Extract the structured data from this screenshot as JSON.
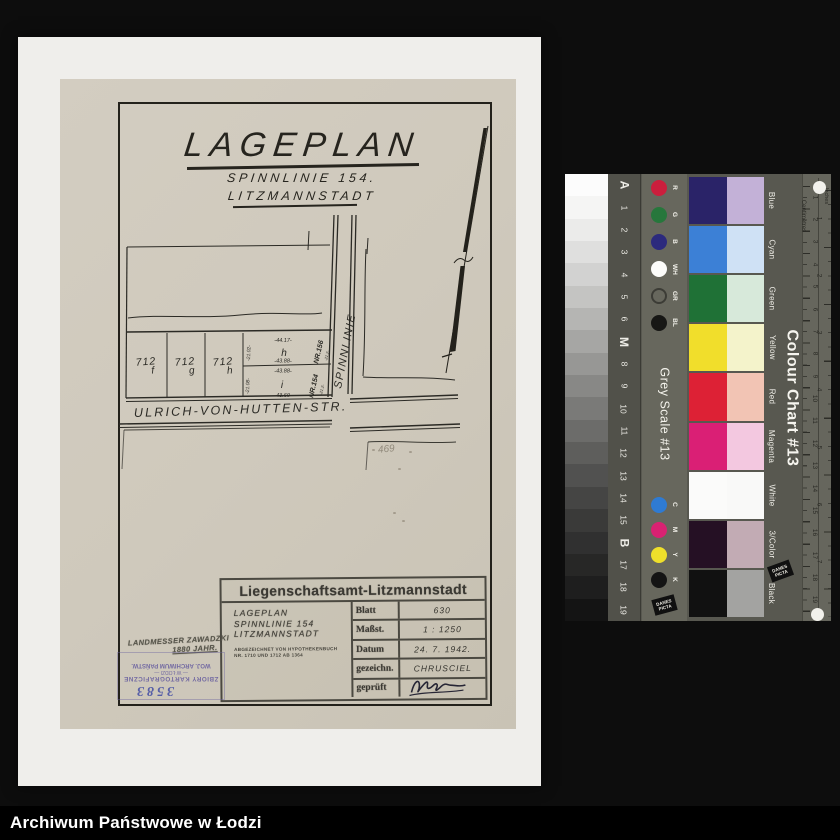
{
  "footer": {
    "archive_name": "Archiwum Państwowe w Łodzi"
  },
  "document": {
    "title": "LAGEPLAN",
    "subtitle1": "SPINNLINIE 154.",
    "subtitle2": "LITZMANNSTADT",
    "map": {
      "street_vertical": "SPINNLINIE",
      "street_horizontal": "ULRICH-VON-HUTTEN-STR.",
      "plots": [
        {
          "number": "712",
          "letter": "f"
        },
        {
          "number": "712",
          "letter": "g"
        },
        {
          "number": "712",
          "letter": "h"
        }
      ],
      "parcels": [
        {
          "label": "h",
          "nr": "NR.156",
          "top": "-44.17-",
          "bottom": "-43.88-",
          "left": "-21.02-",
          "side": "-21.2-"
        },
        {
          "label": "i",
          "nr": "NR.154",
          "top": "-43.88-",
          "bottom": "-43.60-",
          "left": "-21.08-",
          "side": "-21.2-"
        }
      ],
      "pencil_note": "469"
    },
    "title_block": {
      "header": "Liegenschaftsamt-Litzmannstadt",
      "project_lines": [
        "LAGEPLAN",
        "SPINNLINIE 154",
        "LITZMANNSTADT"
      ],
      "note_lines": [
        "ABGEZEICHNET VON HYPOTHEKENBUCH",
        "NR. 1710 UND 1712 AB 1364"
      ],
      "rows": [
        {
          "label": "Blatt",
          "value": "630"
        },
        {
          "label": "Maßst.",
          "value": "1 : 1250"
        },
        {
          "label": "Datum",
          "value": "24. 7. 1942."
        },
        {
          "label": "gezeichn.",
          "value": "CHRUSCIEL"
        },
        {
          "label": "geprüft",
          "value": ""
        }
      ]
    },
    "stamps": {
      "surveyor_line1": "LANDMESSER ZAWADZKI",
      "surveyor_line2": "1880 JAHR.",
      "archive_stamp": {
        "number": "3583",
        "line1": "ZBIORY KARTOGRAFICZNE",
        "line2": "— W ŁODZI —",
        "line3": "WOJ. ARCHIWUM PAŃSTW."
      }
    }
  },
  "calibration": {
    "grey_scale_title": "Grey Scale #13",
    "colour_chart_title": "Colour Chart #13",
    "brand": "DANES PICTA",
    "cm_label": "Centimetres",
    "inch_label": "Inches",
    "grey_steps": [
      "#fcfcfc",
      "#f5f5f4",
      "#ebebea",
      "#dfdfde",
      "#d2d2d1",
      "#c4c4c2",
      "#b5b5b3",
      "#a6a6a4",
      "#979795",
      "#888886",
      "#7a7a78",
      "#6c6c6a",
      "#5e5e5c",
      "#515150",
      "#454544",
      "#3a3a39",
      "#303030",
      "#272726",
      "#1e1e1e",
      "#141414"
    ],
    "index_labels": [
      {
        "t": "A",
        "s": "12px",
        "w": "bold"
      },
      {
        "t": "1",
        "s": "8.5px",
        "w": "normal"
      },
      {
        "t": "2",
        "s": "8.5px",
        "w": "normal"
      },
      {
        "t": "3",
        "s": "8.5px",
        "w": "normal"
      },
      {
        "t": "4",
        "s": "8.5px",
        "w": "normal"
      },
      {
        "t": "5",
        "s": "8.5px",
        "w": "normal"
      },
      {
        "t": "6",
        "s": "8.5px",
        "w": "normal"
      },
      {
        "t": "M",
        "s": "12px",
        "w": "bold"
      },
      {
        "t": "8",
        "s": "8.5px",
        "w": "normal"
      },
      {
        "t": "9",
        "s": "8.5px",
        "w": "normal"
      },
      {
        "t": "10",
        "s": "8.5px",
        "w": "normal"
      },
      {
        "t": "11",
        "s": "8.5px",
        "w": "normal"
      },
      {
        "t": "12",
        "s": "8.5px",
        "w": "normal"
      },
      {
        "t": "13",
        "s": "8.5px",
        "w": "normal"
      },
      {
        "t": "14",
        "s": "8.5px",
        "w": "normal"
      },
      {
        "t": "15",
        "s": "8.5px",
        "w": "normal"
      },
      {
        "t": "B",
        "s": "12px",
        "w": "bold"
      },
      {
        "t": "17",
        "s": "8.5px",
        "w": "normal"
      },
      {
        "t": "18",
        "s": "8.5px",
        "w": "normal"
      },
      {
        "t": "19",
        "s": "8.5px",
        "w": "normal"
      }
    ],
    "dots_top": [
      {
        "label": "R",
        "bg": "#cb1e3d",
        "border": "#cb1e3d"
      },
      {
        "label": "G",
        "bg": "#27773c",
        "border": "#27773c"
      },
      {
        "label": "B",
        "bg": "#2c2a7d",
        "border": "#2c2a7d"
      },
      {
        "label": "WH",
        "bg": "#fcfcfa",
        "border": "#fcfcfa"
      },
      {
        "label": "GR",
        "bg": "transparent",
        "border": "#3c3c36"
      },
      {
        "label": "BL",
        "bg": "#171715",
        "border": "#171715"
      }
    ],
    "dots_bottom": [
      {
        "label": "C",
        "bg": "#2f7bd3",
        "border": "#2f7bd3"
      },
      {
        "label": "M",
        "bg": "#d92272",
        "border": "#d92272"
      },
      {
        "label": "Y",
        "bg": "#eedf2b",
        "border": "#eedf2b"
      },
      {
        "label": "K",
        "bg": "#141414",
        "border": "#141414"
      }
    ],
    "color_rows": [
      {
        "label": "Blue",
        "solid": "#2a2368",
        "tint": "#c3b1d7"
      },
      {
        "label": "Cyan",
        "solid": "#3c80d6",
        "tint": "#cfe1f5"
      },
      {
        "label": "Green",
        "solid": "#1f7136",
        "tint": "#d7e9da"
      },
      {
        "label": "Yellow",
        "solid": "#f1de2b",
        "tint": "#f4f3cb"
      },
      {
        "label": "Red",
        "solid": "#dd2135",
        "tint": "#f2c4b4"
      },
      {
        "label": "Magenta",
        "solid": "#da1f75",
        "tint": "#f3c8e0"
      },
      {
        "label": "White",
        "solid": "#fbfbfa",
        "tint": "#f9f9f8"
      },
      {
        "label": "3/Color",
        "solid": "#251024",
        "tint": "#c2abb4"
      },
      {
        "label": "Black",
        "solid": "#111111",
        "tint": "#a3a3a1"
      }
    ],
    "cm_numbers": [
      "1",
      "2",
      "3",
      "4",
      "5",
      "6",
      "7",
      "8",
      "9",
      "10",
      "11",
      "12",
      "13",
      "14",
      "15",
      "16",
      "17",
      "18",
      "19"
    ],
    "inch_numbers": [
      "1",
      "2",
      "3",
      "4",
      "5",
      "6",
      "7"
    ]
  }
}
